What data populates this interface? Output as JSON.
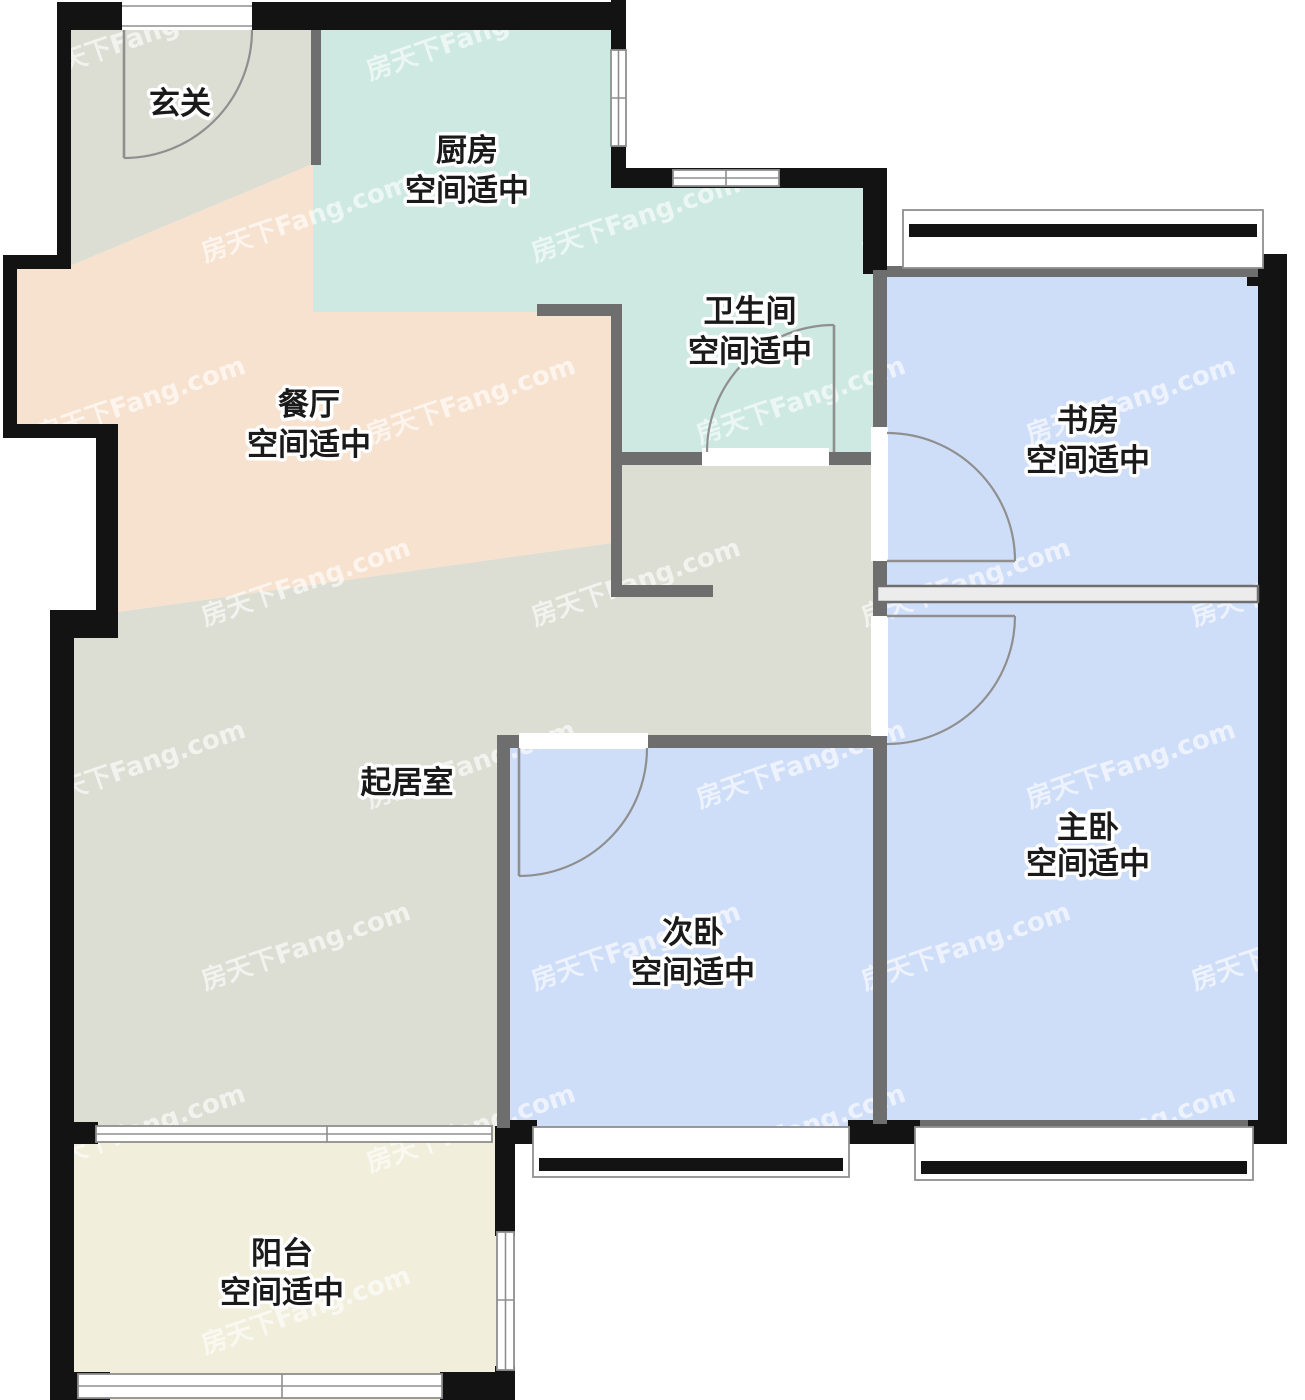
{
  "watermark": {
    "text": "房天下Fang.com"
  },
  "palette": {
    "wall_color": "#131313",
    "thin_wall_color": "#6e6e6e",
    "line_color": "#8f8f8f",
    "text_color": "#1a1a1a",
    "cavity_fill": "#ececec",
    "background": "#ffffff",
    "watermark_color": "rgba(255,255,255,0.62)"
  },
  "rooms": [
    {
      "id": "foyer",
      "name": "玄关",
      "note": "",
      "color": "#dcddd3"
    },
    {
      "id": "kitchen",
      "name": "厨房",
      "note": "空间适中",
      "color": "#cde9e1"
    },
    {
      "id": "bathroom",
      "name": "卫生间",
      "note": "空间适中",
      "color": "#cde9e1"
    },
    {
      "id": "study",
      "name": "书房",
      "note": "空间适中",
      "color": "#cfdef8"
    },
    {
      "id": "dining",
      "name": "餐厅",
      "note": "空间适中",
      "color": "#f6e2cf"
    },
    {
      "id": "living",
      "name": "起居室",
      "note": "",
      "color": "#dcddd3"
    },
    {
      "id": "secondary-bedroom",
      "name": "次卧",
      "note": "空间适中",
      "color": "#cfdef8"
    },
    {
      "id": "master-bedroom",
      "name": "主卧",
      "note": "空间适中",
      "color": "#cfdef8"
    },
    {
      "id": "balcony",
      "name": "阳台",
      "note": "空间适中",
      "color": "#f1eedb"
    }
  ]
}
